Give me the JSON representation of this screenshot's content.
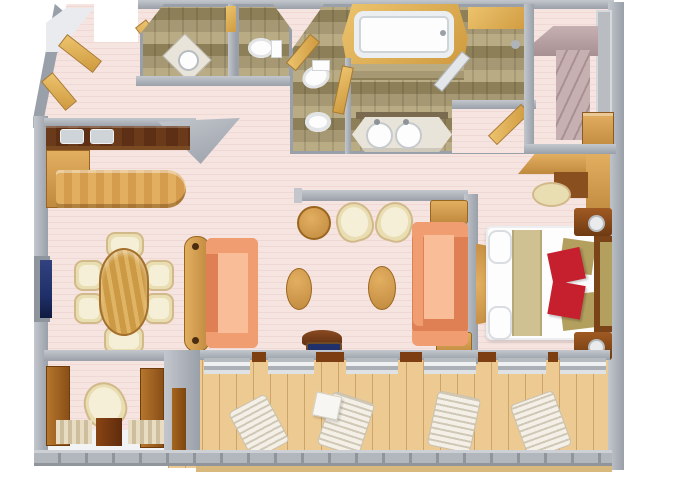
{
  "meta": {
    "title": "3D floor plan rendering of a ship suite, top-down view",
    "visible_text": "none"
  },
  "colors": {
    "floor_pink": "#f6e4e1",
    "floor_pink_line": "#f0d8d4",
    "wall": "#9aa0a9",
    "wall_light": "#c3c7cd",
    "wall_dark": "#81878f",
    "tile": "#a59873",
    "tile_light": "#b9ac84",
    "tile_dark": "#8d8058",
    "wood": "#c08a3e",
    "wood_light": "#e2ae60",
    "wood_dark": "#8a4f1e",
    "wood_gold": "#cf9a3f",
    "wood_gold_light": "#ecc36d",
    "counter_dark": "#5d2f15",
    "deck": "#ecca92",
    "deck_line": "#cda56a",
    "railing": "#b2b7bd",
    "railing_post": "#8f959b",
    "cream": "#e9ddb2",
    "cream_dark": "#d2b98a",
    "cream_light": "#f6efd7",
    "salmon": "#f09d72",
    "salmon_light": "#f9bd98",
    "salmon_dark": "#de7f54",
    "white_fixture": "#fdfdfd",
    "fixture_shadow": "#d9dde1",
    "marble": "#e8e4da",
    "mauve": "#c6b0b1",
    "mauve_dark": "#a89093",
    "navy": "#20306b",
    "red_pillow": "#c61f2e",
    "olive_pillow": "#b3a05e",
    "khaki": "#cfc192",
    "outside": "#ffffff"
  },
  "scene": {
    "rooms": [
      {
        "name": "entry-foyer",
        "items": [
          "corner-shelves",
          "wardrobe-doors",
          "entry-door-opening"
        ]
      },
      {
        "name": "guest-bathroom",
        "items": [
          "corner-sink",
          "door"
        ]
      },
      {
        "name": "guest-toilet-room",
        "items": [
          "toilet"
        ]
      },
      {
        "name": "master-bathroom",
        "items": [
          "bathtub",
          "tile-ledge",
          "toilet",
          "bidet",
          "double-sink-vanity",
          "shower",
          "glass-shower-door"
        ]
      },
      {
        "name": "walk-in-closet",
        "items": [
          "wardrobe",
          "drawer-chest",
          "shelf-wall"
        ]
      },
      {
        "name": "dressing-area",
        "items": [
          "vanity-desk",
          "stool"
        ]
      },
      {
        "name": "bedroom",
        "items": [
          "king-bed",
          "red-accent-pillows",
          "olive-accent-pillows",
          "headboard",
          "nightstand-with-lamp-left",
          "nightstand-with-lamp-right",
          "half-round-table"
        ]
      },
      {
        "name": "living-dining-room",
        "items": [
          "wet-bar-counter-with-sinks",
          "bar-cabinet",
          "curved-bar",
          "tv",
          "oval-dining-table",
          "six-dining-chairs",
          "sofa",
          "console-table",
          "round-table",
          "two-tub-chairs",
          "two-oval-coffee-tables",
          "second-sofa",
          "two-side-tables",
          "chair-with-navy-cushion"
        ]
      },
      {
        "name": "sitting-nook",
        "items": [
          "tub-chair",
          "cabinet-doors",
          "sliding-door"
        ]
      },
      {
        "name": "veranda",
        "items": [
          "sun-lounger-1",
          "sun-lounger-2",
          "sun-lounger-3",
          "sun-lounger-4",
          "small-white-table",
          "railing",
          "wood-deck",
          "sliding-door-sills"
        ]
      }
    ]
  }
}
